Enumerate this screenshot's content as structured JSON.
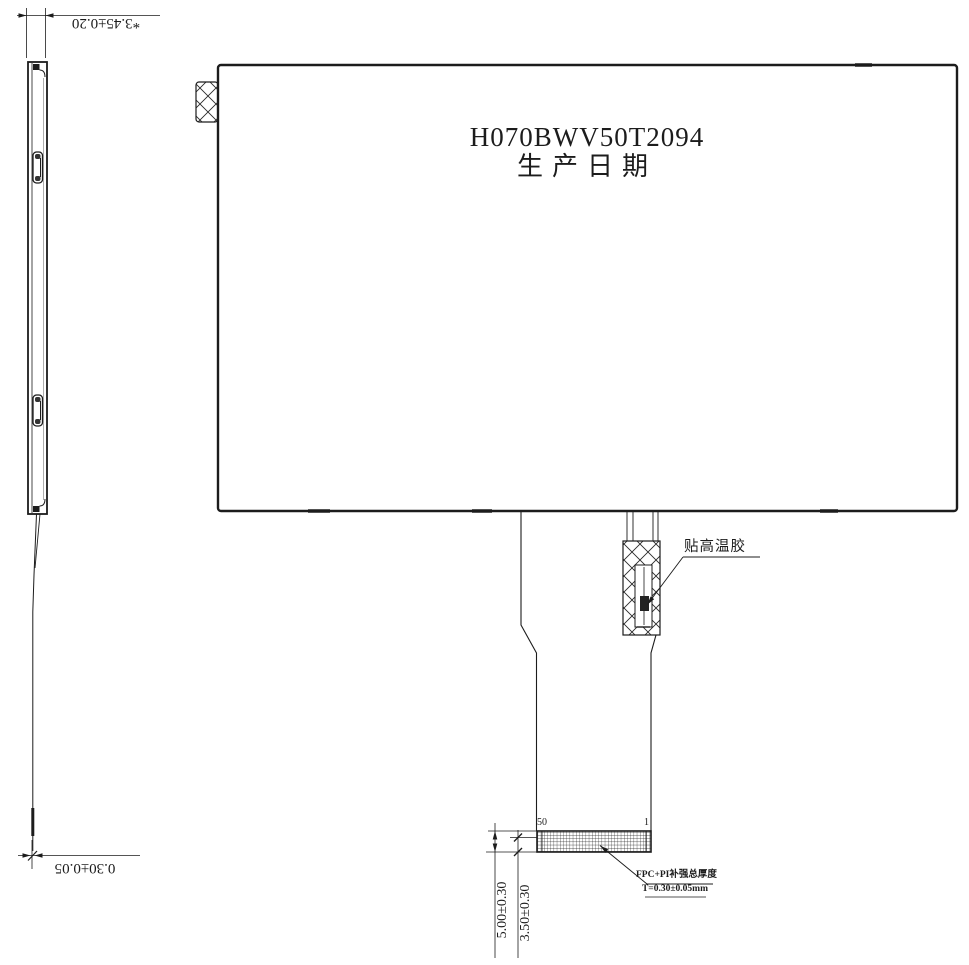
{
  "drawing": {
    "side_view": {
      "thickness_dim": "*3.45±0.20",
      "fpc_thickness_dim": "0.30±0.05"
    },
    "front_view": {
      "model": "H070BWV50T2094",
      "date_label": "生产日期"
    },
    "fpc": {
      "tape_label": "贴高温胶",
      "pin_start": "50",
      "pin_end": "1",
      "stiffener_note_line1": "FPC+PI补强总厚度",
      "stiffener_note_line2": "T=0.30±0.05mm",
      "connector_height_dim": "5.00±0.30",
      "contact_height_dim": "3.50±0.30"
    },
    "colors": {
      "line": "#1c1c1c",
      "background": "#ffffff"
    }
  }
}
